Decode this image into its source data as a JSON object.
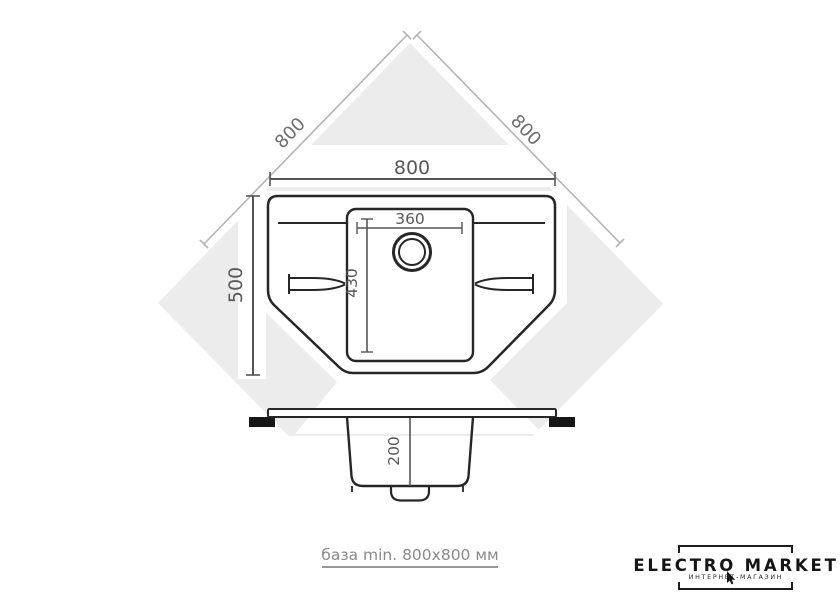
{
  "diagram": {
    "subject": "corner sink dimension drawing",
    "dimensions": {
      "base_side_left": "800",
      "base_side_right": "800",
      "overall_width": "800",
      "overall_depth": "500",
      "bowl_width": "360",
      "bowl_length": "430",
      "bowl_depth": "200"
    }
  },
  "footer": {
    "note": "база min. 800x800 мм"
  },
  "logo": {
    "title": "ELECTRO MARKET",
    "subtitle": "ИНТЕРНЕТ-МАГАЗИН"
  },
  "colors": {
    "diamond_fill": "#ececec",
    "line_dark": "#262626",
    "dim_line": "#555555",
    "dim_text": "#575757",
    "diag_line": "#b3b3b3",
    "diag_text": "#6e6e6e",
    "clip_fill": "#161616",
    "footer_text": "#8a8a8a",
    "logo_text": "#151515"
  }
}
